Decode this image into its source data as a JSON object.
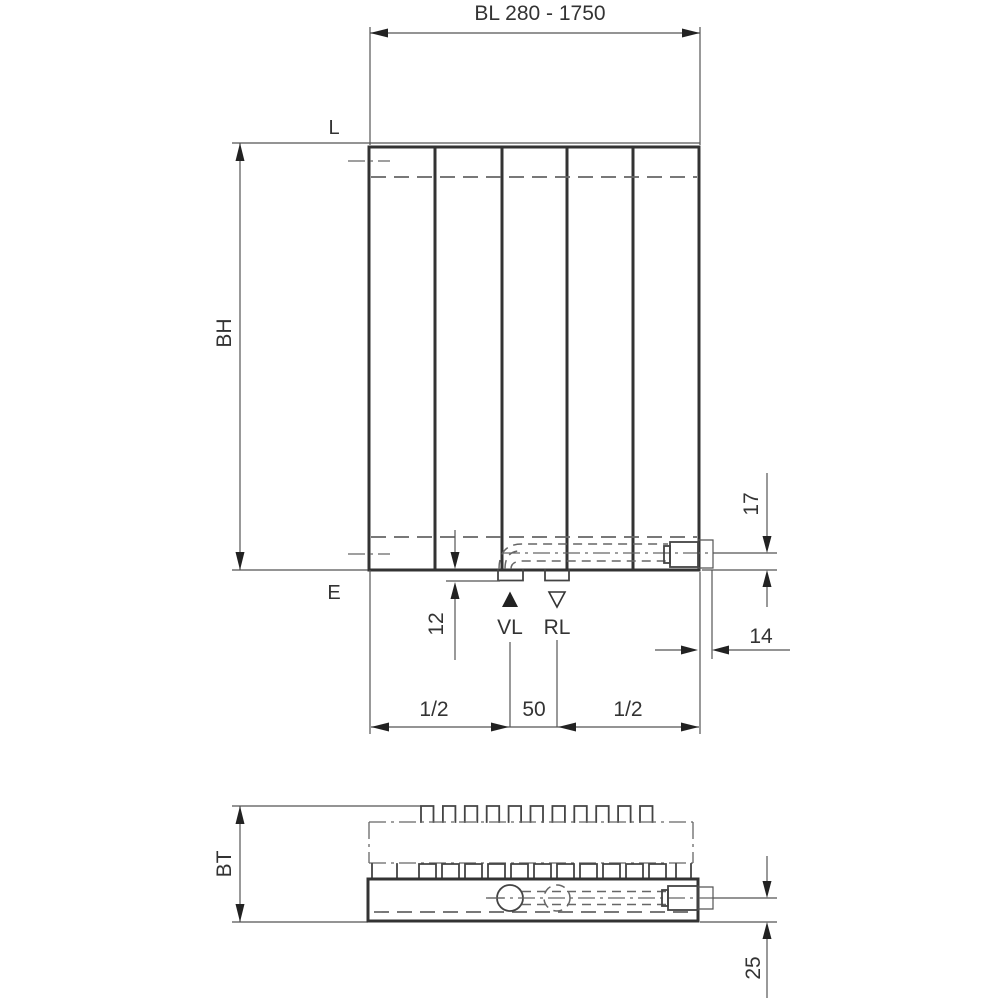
{
  "drawing": {
    "overall_length_label": "BL 280 - 1750",
    "top_reference_label": "L",
    "bottom_reference_label": "E",
    "height_label": "BH",
    "depth_label": "BT",
    "supply_label": "VL",
    "return_label": "RL",
    "dim_12": "12",
    "dim_17": "17",
    "dim_14": "14",
    "dim_25": "25",
    "dim_50": "50",
    "dim_half_left": "1/2",
    "dim_half_right": "1/2"
  },
  "colors": {
    "outline": "#333333",
    "thin_line": "#555555",
    "hidden_line": "#666666",
    "text": "#333333",
    "background": "#ffffff"
  }
}
